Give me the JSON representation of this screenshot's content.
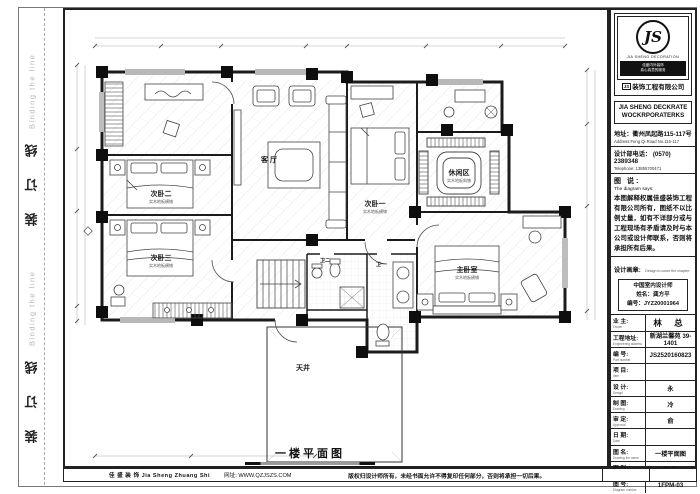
{
  "binding": {
    "cn": "装 订 线",
    "en": "Binding the line"
  },
  "titleblock": {
    "logo": {
      "monogram": "JS",
      "sub": "JIA SHENG DECORATION",
      "tag1": "佳盛内外装饰",
      "tag2": "真心真意的服务",
      "prefix": "JS",
      "company_cn": "装饰工程有限公司",
      "en1": "JIA SHENG DECKRATE",
      "en2": "WOCKRPORATERKS"
    },
    "address_cn": "地址：衢州凤起路115-117号",
    "address_en": "Address:Feng Qi Road No.115-117",
    "tel_cn": "设计部电话： (0570) 2389348",
    "tel_en": "Telephone:  13855700471",
    "says_cn": "图 说:",
    "says_en": "The diagram says:",
    "says_body": "本图解释权属佳盛装饰工程有限公司所有，图纸不以比例丈量，如有不详部分或与工程现场有矛盾请及时与本公司或设计师联系，否则将承担所有后果。",
    "seal_cn": "设计画章:",
    "seal_en": "Design to cover the chapter:",
    "seal_line1": "中国室内设计师",
    "seal_line2": "姓名：龚方平",
    "seal_line3": "编号：JYZ20001964",
    "rows": [
      {
        "cn": "业 主:",
        "en": "Owner",
        "value": "林 总"
      },
      {
        "cn": "工程地址:",
        "en": "Engineering address",
        "value": "新湖兰馨苑 39-1401"
      },
      {
        "cn": "编 号:",
        "en": "Part number",
        "value": "JS2520160823"
      },
      {
        "cn": "项 目:",
        "en": "Item",
        "value": ""
      },
      {
        "cn": "设 计:",
        "en": "Design",
        "value": "永"
      },
      {
        "cn": "制 图:",
        "en": "Drawing",
        "value": "冷"
      },
      {
        "cn": "审 定:",
        "en": "Approval",
        "value": "俞"
      },
      {
        "cn": "日 期:",
        "en": "Date",
        "value": ""
      },
      {
        "cn": "图 名:",
        "en": "Drawing the name",
        "value": "一楼平面图"
      },
      {
        "cn": "图 别:",
        "en": "Diagram do not",
        "value": "饰 施"
      },
      {
        "cn": "图 号:",
        "en": "Diagram number",
        "value": "1FPM-03"
      }
    ]
  },
  "plan": {
    "caption": "一楼平面图",
    "rooms": [
      {
        "name": "次卧二",
        "note": "实木地板横铺"
      },
      {
        "name": "次卧三",
        "note": "实木地板横铺"
      },
      {
        "name": "客 厅",
        "note": ""
      },
      {
        "name": "次卧一",
        "note": "实木地板横铺"
      },
      {
        "name": "休闲区",
        "note": "实木地板斜铺"
      },
      {
        "name": "主卧室",
        "note": "实木地板横铺"
      },
      {
        "name": "天井",
        "note": ""
      },
      {
        "name": "卫一",
        "note": ""
      },
      {
        "name": "卫二",
        "note": ""
      }
    ]
  },
  "footer": {
    "left": "佳 盛 装 饰 Jia Sheng Zhuang Shi",
    "left2": "网址: WWW.QZJSZS.COM",
    "right": "版权归设计师所有，未经书面允许不得复印任何部分，否则将承担一切后果。"
  }
}
